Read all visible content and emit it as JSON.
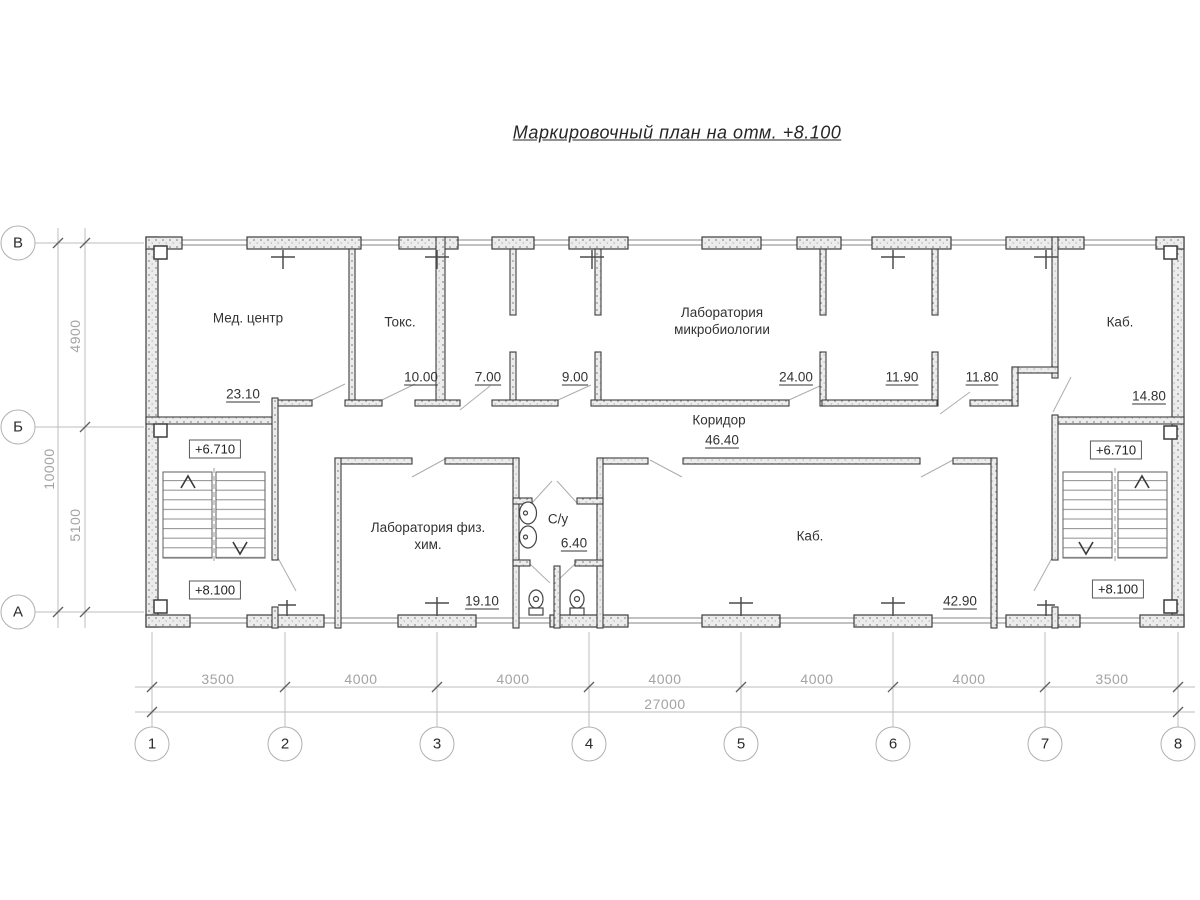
{
  "title": "Маркировочный план на отм. +8.100",
  "rooms": {
    "med_center": {
      "name": "Мед. центр",
      "area": "23.10"
    },
    "toks": {
      "name": "Токс.",
      "area": "10.00"
    },
    "r7": {
      "area": "7.00"
    },
    "r9": {
      "area": "9.00"
    },
    "lab_micro": {
      "name": "Лаборатория микробиологии",
      "area": "24.00"
    },
    "r1190": {
      "area": "11.90"
    },
    "r1180": {
      "area": "11.80"
    },
    "kab_top": {
      "name": "Каб.",
      "area": "14.80"
    },
    "corridor": {
      "name": "Коридор",
      "area": "46.40"
    },
    "lab_chem": {
      "name": "Лаборатория физ. хим.",
      "area": "19.10"
    },
    "su": {
      "name": "С/у",
      "area": "6.40"
    },
    "kab_bottom": {
      "name": "Каб.",
      "area": "42.90"
    }
  },
  "elevations": {
    "upper": "+6.710",
    "lower": "+8.100"
  },
  "axes": {
    "columns": [
      "1",
      "2",
      "3",
      "4",
      "5",
      "6",
      "7",
      "8"
    ],
    "rows": [
      "В",
      "Б",
      "А"
    ]
  },
  "dimensions": {
    "column_spacings": [
      "3500",
      "4000",
      "4000",
      "4000",
      "4000",
      "4000",
      "3500"
    ],
    "total_width": "27000",
    "row_spacings": [
      "4900",
      "5100"
    ],
    "total_height": "10000"
  }
}
